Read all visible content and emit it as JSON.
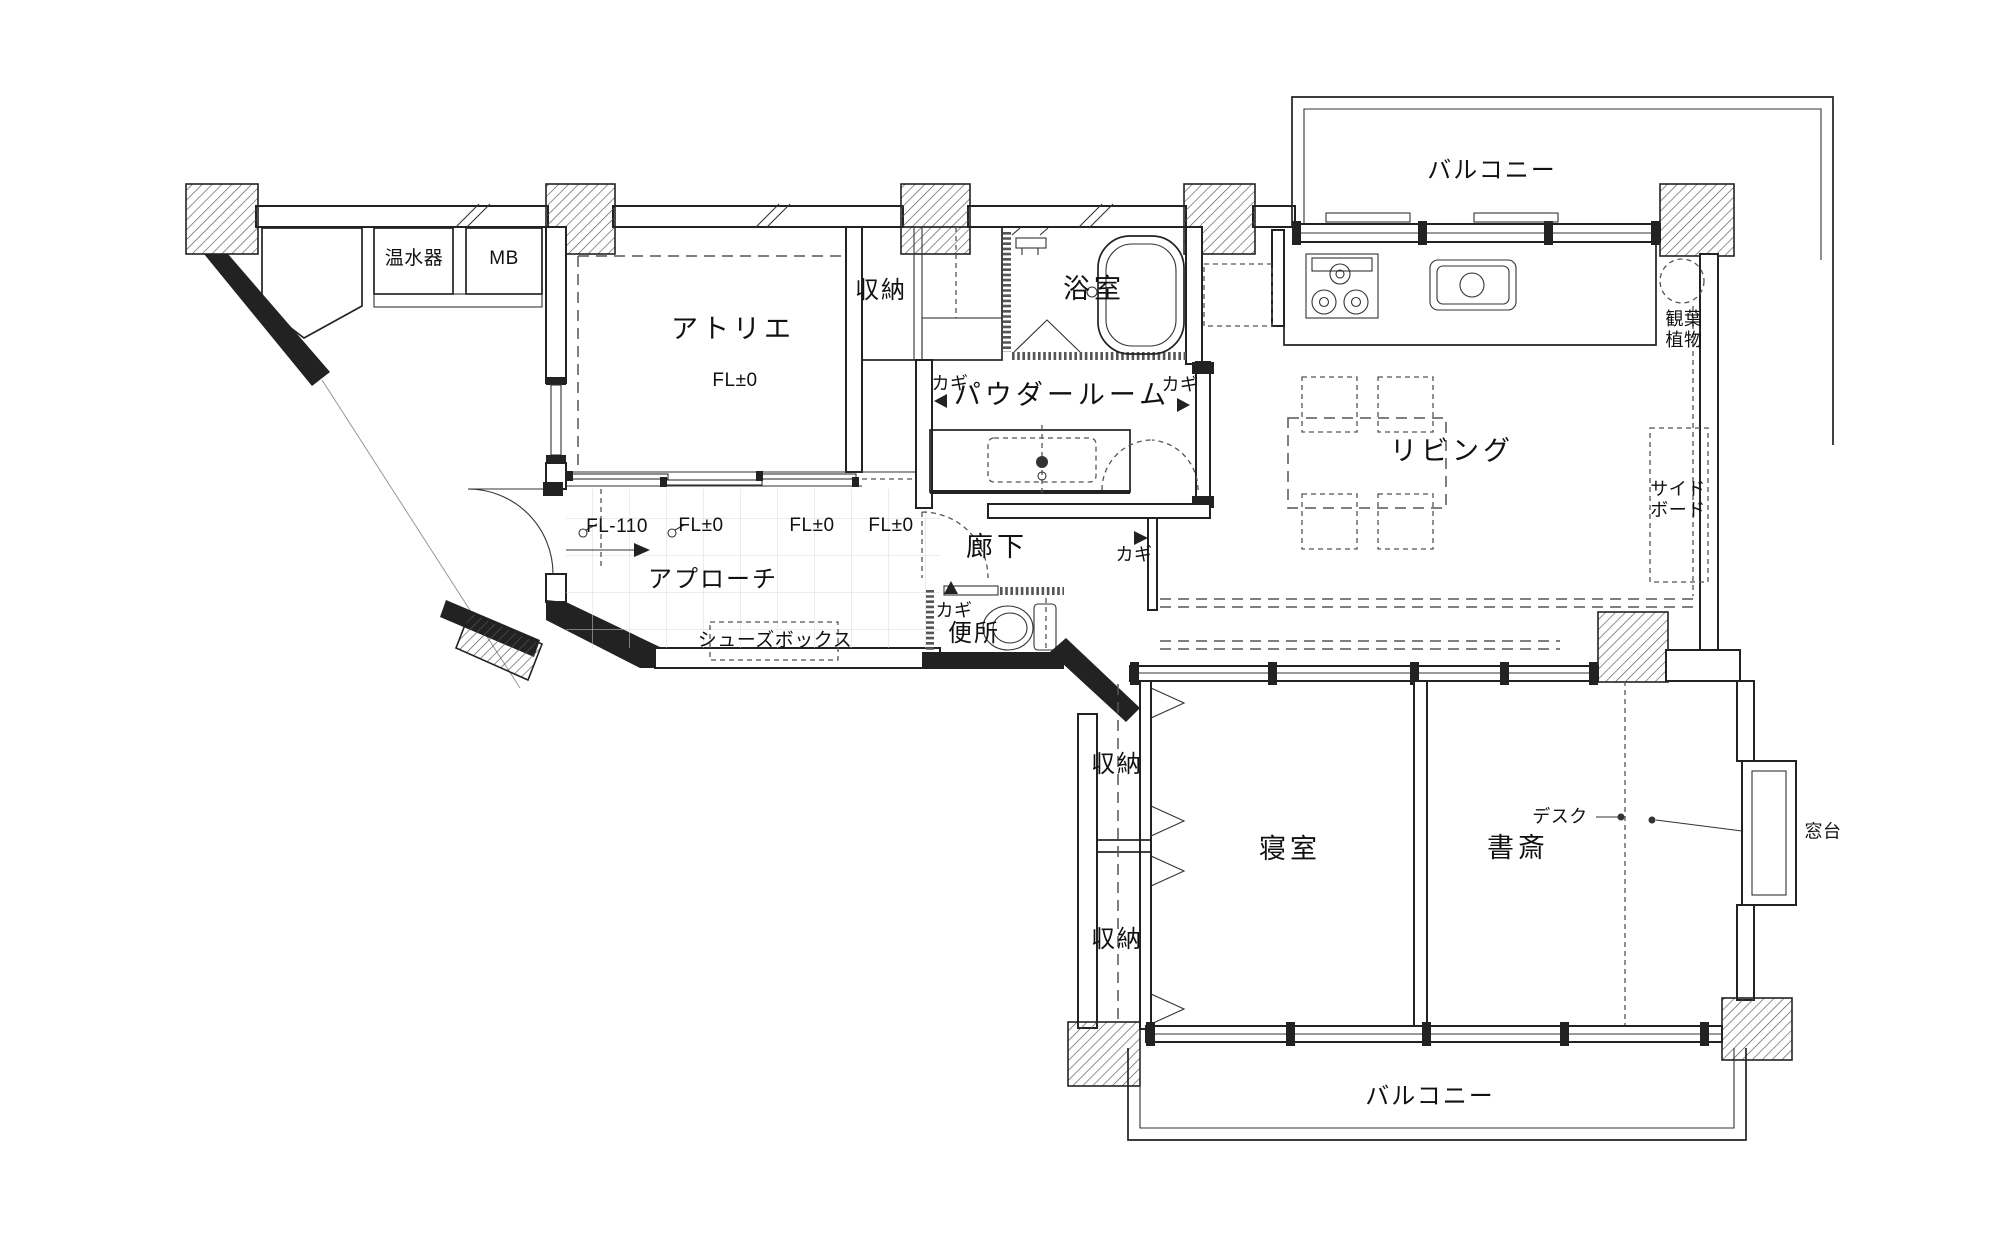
{
  "rooms": {
    "atelier": {
      "name": "アトリエ",
      "floor_level": "FL±0"
    },
    "storage_top": {
      "name": "収納"
    },
    "bathroom": {
      "name": "浴室"
    },
    "powder_room": {
      "name": "パウダールーム"
    },
    "living": {
      "name": "リビング"
    },
    "corridor": {
      "name": "廊下"
    },
    "toilet": {
      "name": "便所"
    },
    "approach": {
      "name": "アプローチ"
    },
    "bedroom": {
      "name": "寝室"
    },
    "study": {
      "name": "書斎"
    },
    "storage_bedroom_upper": {
      "name": "収納"
    },
    "storage_bedroom_lower": {
      "name": "収納"
    },
    "balcony_top": {
      "name": "バルコニー"
    },
    "balcony_bottom": {
      "name": "バルコニー"
    }
  },
  "equipment": {
    "water_heater": "温水器",
    "meter_box": "MB",
    "shoes_box": "シューズボックス",
    "sideboard": "サイド\nボード",
    "houseplant": "観葉\n植物",
    "desk": "デスク",
    "window_sill": "窓台"
  },
  "floor_levels": {
    "entry": "FL-110",
    "approach_1": "FL±0",
    "approach_2": "FL±0",
    "approach_3": "FL±0"
  },
  "door_keys": {
    "powder_west": "カギ",
    "powder_east": "カギ",
    "corridor_east": "カギ",
    "toilet": "カギ"
  }
}
